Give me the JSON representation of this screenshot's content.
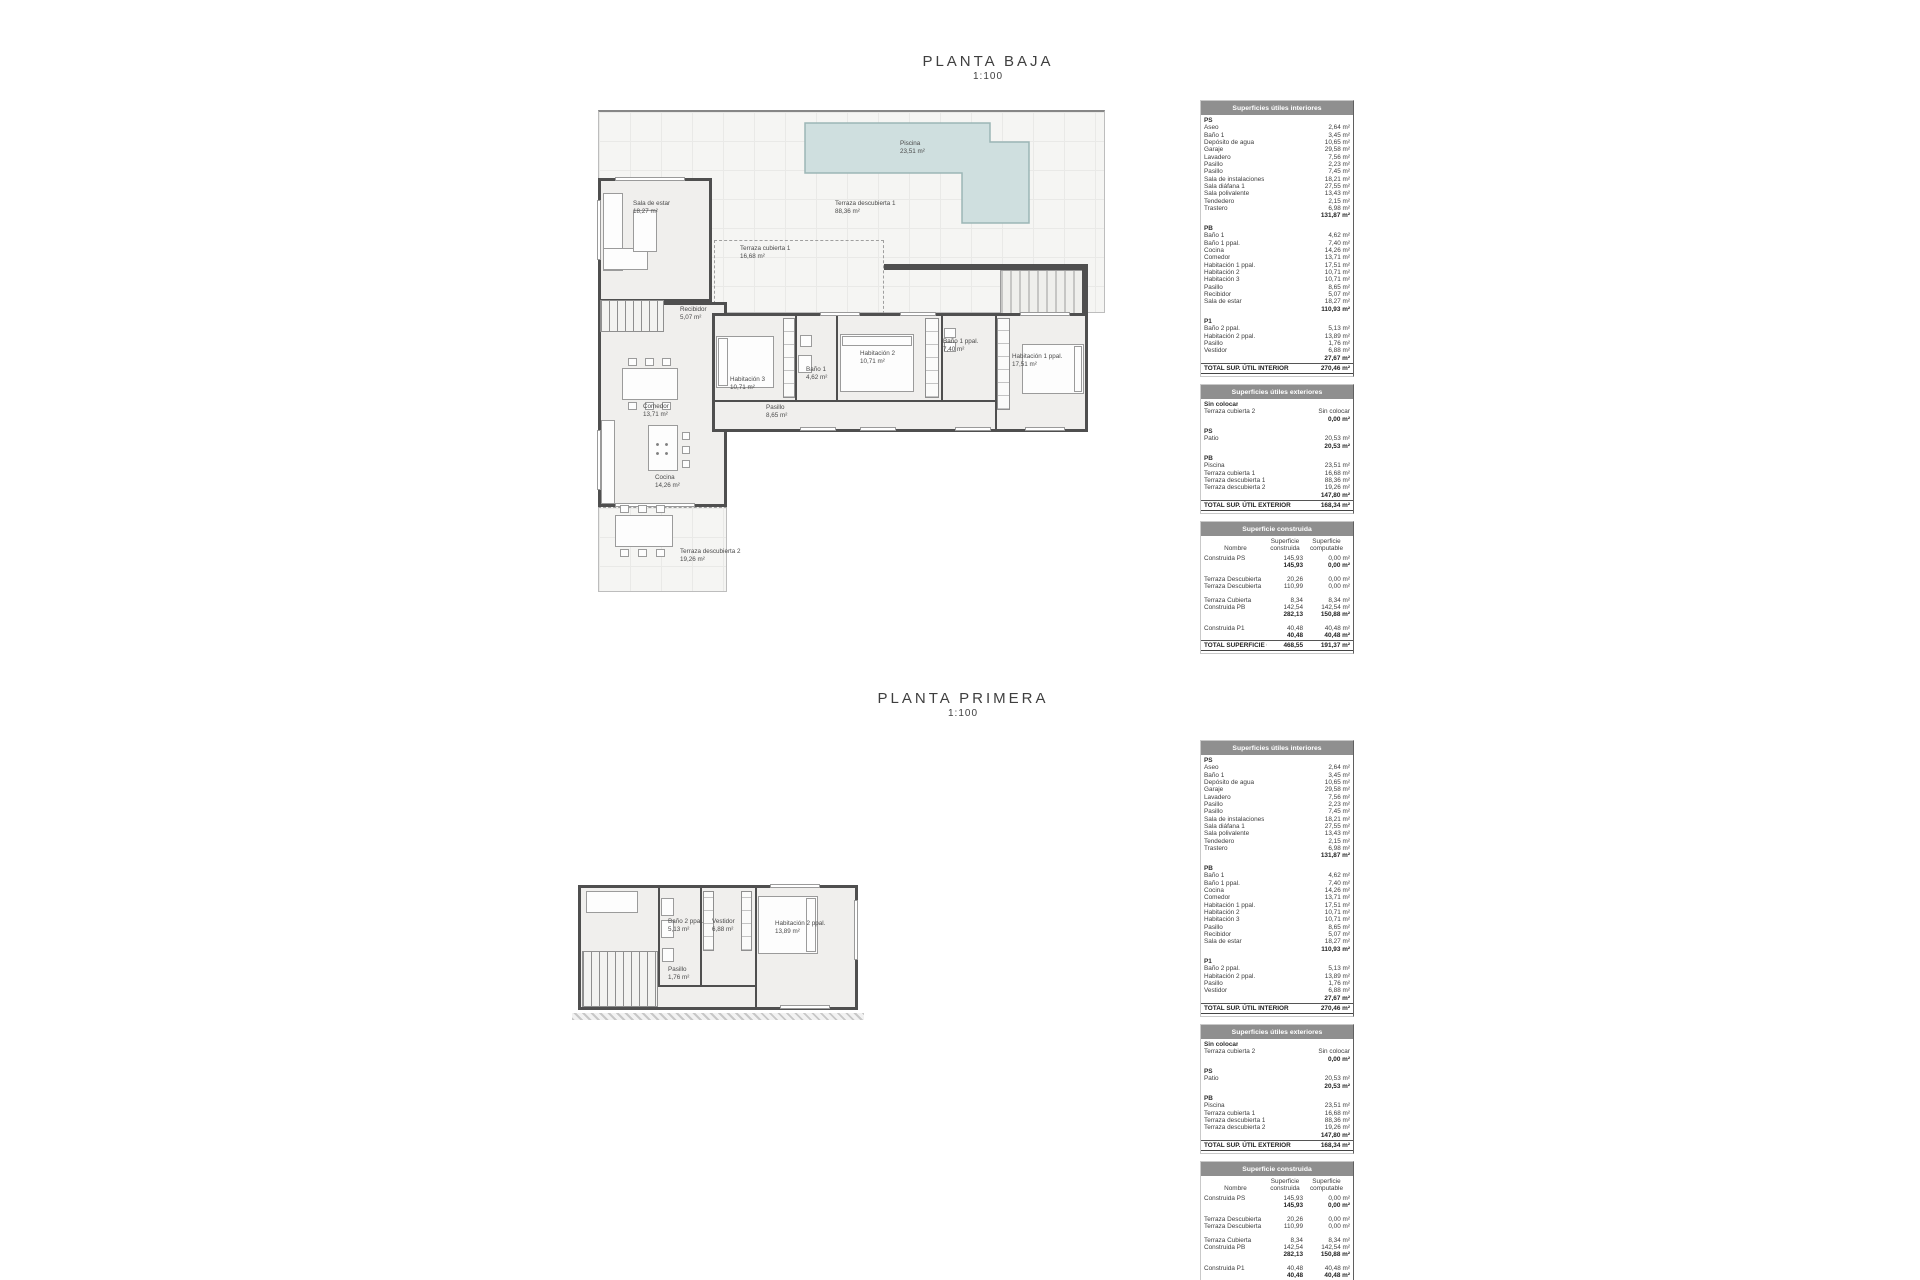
{
  "plan_baja": {
    "title": "PLANTA BAJA",
    "scale": "1:100",
    "rooms": {
      "piscina": {
        "name": "Piscina",
        "area": "23,51 m²"
      },
      "terraza_d1": {
        "name": "Terraza descubierta 1",
        "area": "88,36 m²"
      },
      "terraza_c1": {
        "name": "Terraza cubierta 1",
        "area": "16,68 m²"
      },
      "sala_estar": {
        "name": "Sala de estar",
        "area": "18,27 m²"
      },
      "recibidor": {
        "name": "Recibidor",
        "area": "5,07 m²"
      },
      "comedor": {
        "name": "Comedor",
        "area": "13,71 m²"
      },
      "cocina": {
        "name": "Cocina",
        "area": "14,26 m²"
      },
      "terraza_d2": {
        "name": "Terraza descubierta 2",
        "area": "19,26 m²"
      },
      "hab3": {
        "name": "Habitación 3",
        "area": "10,71 m²"
      },
      "bano1": {
        "name": "Baño 1",
        "area": "4,62 m²"
      },
      "hab2": {
        "name": "Habitación 2",
        "area": "10,71 m²"
      },
      "bano1ppal": {
        "name": "Baño 1 ppal.",
        "area": "7,40 m²"
      },
      "hab1ppal": {
        "name": "Habitación 1 ppal.",
        "area": "17,51 m²"
      },
      "pasillo": {
        "name": "Pasillo",
        "area": "8,65 m²"
      }
    }
  },
  "plan_primera": {
    "title": "PLANTA PRIMERA",
    "scale": "1:100",
    "rooms": {
      "bano2ppal": {
        "name": "Baño 2 ppal.",
        "area": "5,13 m²"
      },
      "vestidor": {
        "name": "Vestidor",
        "area": "6,88 m²"
      },
      "hab2ppal": {
        "name": "Habitación 2 ppal.",
        "area": "13,89 m²"
      },
      "pasillo": {
        "name": "Pasillo",
        "area": "1,76 m²"
      }
    }
  },
  "colors": {
    "wall": "#4f4f4f",
    "pool_fill": "#cfdfdf",
    "pool_stroke": "#9cb6b6",
    "table_header_bg": "#8f8f8f",
    "table_header_text": "#ffffff"
  },
  "surface_tables": {
    "interior": {
      "title": "Superficies útiles interiores",
      "groups": [
        {
          "label": "PS",
          "rows": [
            {
              "n": "Aseo",
              "v": "2,64 m²"
            },
            {
              "n": "Baño 1",
              "v": "3,45 m²"
            },
            {
              "n": "Depósito de agua",
              "v": "10,65 m²"
            },
            {
              "n": "Garaje",
              "v": "29,58 m²"
            },
            {
              "n": "Lavadero",
              "v": "7,56 m²"
            },
            {
              "n": "Pasillo",
              "v": "2,23 m²"
            },
            {
              "n": "Pasillo",
              "v": "7,45 m²"
            },
            {
              "n": "Sala de instalaciones",
              "v": "18,21 m²"
            },
            {
              "n": "Sala diáfana 1",
              "v": "27,55 m²"
            },
            {
              "n": "Sala polivalente",
              "v": "13,43 m²"
            },
            {
              "n": "Tendedero",
              "v": "2,15 m²"
            },
            {
              "n": "Trastero",
              "v": "6,98 m²"
            }
          ],
          "subtotal": "131,87 m²"
        },
        {
          "label": "PB",
          "rows": [
            {
              "n": "Baño 1",
              "v": "4,62 m²"
            },
            {
              "n": "Baño 1 ppal.",
              "v": "7,40 m²"
            },
            {
              "n": "Cocina",
              "v": "14,26 m²"
            },
            {
              "n": "Comedor",
              "v": "13,71 m²"
            },
            {
              "n": "Habitación 1 ppal.",
              "v": "17,51 m²"
            },
            {
              "n": "Habitación 2",
              "v": "10,71 m²"
            },
            {
              "n": "Habitación 3",
              "v": "10,71 m²"
            },
            {
              "n": "Pasillo",
              "v": "8,65 m²"
            },
            {
              "n": "Recibidor",
              "v": "5,07 m²"
            },
            {
              "n": "Sala de estar",
              "v": "18,27 m²"
            }
          ],
          "subtotal": "110,93 m²"
        },
        {
          "label": "P1",
          "rows": [
            {
              "n": "Baño 2 ppal.",
              "v": "5,13 m²"
            },
            {
              "n": "Habitación 2 ppal.",
              "v": "13,89 m²"
            },
            {
              "n": "Pasillo",
              "v": "1,76 m²"
            },
            {
              "n": "Vestidor",
              "v": "6,88 m²"
            }
          ],
          "subtotal": "27,67 m²"
        }
      ],
      "total": {
        "label": "TOTAL SUP.  ÚTIL INTERIOR",
        "value": "270,46 m²"
      }
    },
    "exterior": {
      "title": "Superficies útiles exteriores",
      "groups": [
        {
          "label": "Sin colocar",
          "rows": [
            {
              "n": "Terraza cubierta 2",
              "v": "Sin colocar"
            }
          ],
          "subtotal": "0,00 m²"
        },
        {
          "label": "PS",
          "rows": [
            {
              "n": "Patio",
              "v": "20,53 m²"
            }
          ],
          "subtotal": "20,53 m²"
        },
        {
          "label": "PB",
          "rows": [
            {
              "n": "Piscina",
              "v": "23,51 m²"
            },
            {
              "n": "Terraza cubierta 1",
              "v": "16,68 m²"
            },
            {
              "n": "Terraza descubierta 1",
              "v": "88,36 m²"
            },
            {
              "n": "Terraza descubierta 2",
              "v": "19,26 m²"
            }
          ],
          "subtotal": "147,80 m²"
        }
      ],
      "total": {
        "label": "TOTAL SUP.  ÚTIL EXTERIOR",
        "value": "168,34 m²"
      }
    },
    "construida": {
      "title": "Superficie construida",
      "col_headers": [
        "Nombre",
        "Superficie construida",
        "Superficie computable"
      ],
      "groups": [
        {
          "rows": [
            {
              "n": "Construida PS",
              "c": "145,93",
              "p": "0,00 m²"
            }
          ],
          "subtotal": {
            "c": "145,93",
            "p": "0,00 m²"
          }
        },
        {
          "rows": [
            {
              "n": "Terraza Descubierta",
              "c": "20,26",
              "p": "0,00 m²"
            },
            {
              "n": "Terraza Descubierta",
              "c": "110,99",
              "p": "0,00 m²"
            }
          ]
        },
        {
          "rows": [
            {
              "n": "Terraza Cubierta",
              "c": "8,34",
              "p": "8,34 m²"
            },
            {
              "n": "Construida PB",
              "c": "142,54",
              "p": "142,54 m²"
            }
          ],
          "subtotal": {
            "c": "282,13",
            "p": "150,88 m²"
          }
        },
        {
          "rows": [
            {
              "n": "Construida P1",
              "c": "40,48",
              "p": "40,48 m²"
            }
          ],
          "subtotal": {
            "c": "40,48",
            "p": "40,48 m²"
          }
        }
      ],
      "total": {
        "label": "TOTAL SUPERFICIE CONSTRUIDA:",
        "c": "468,55",
        "p": "191,37 m²"
      }
    }
  }
}
